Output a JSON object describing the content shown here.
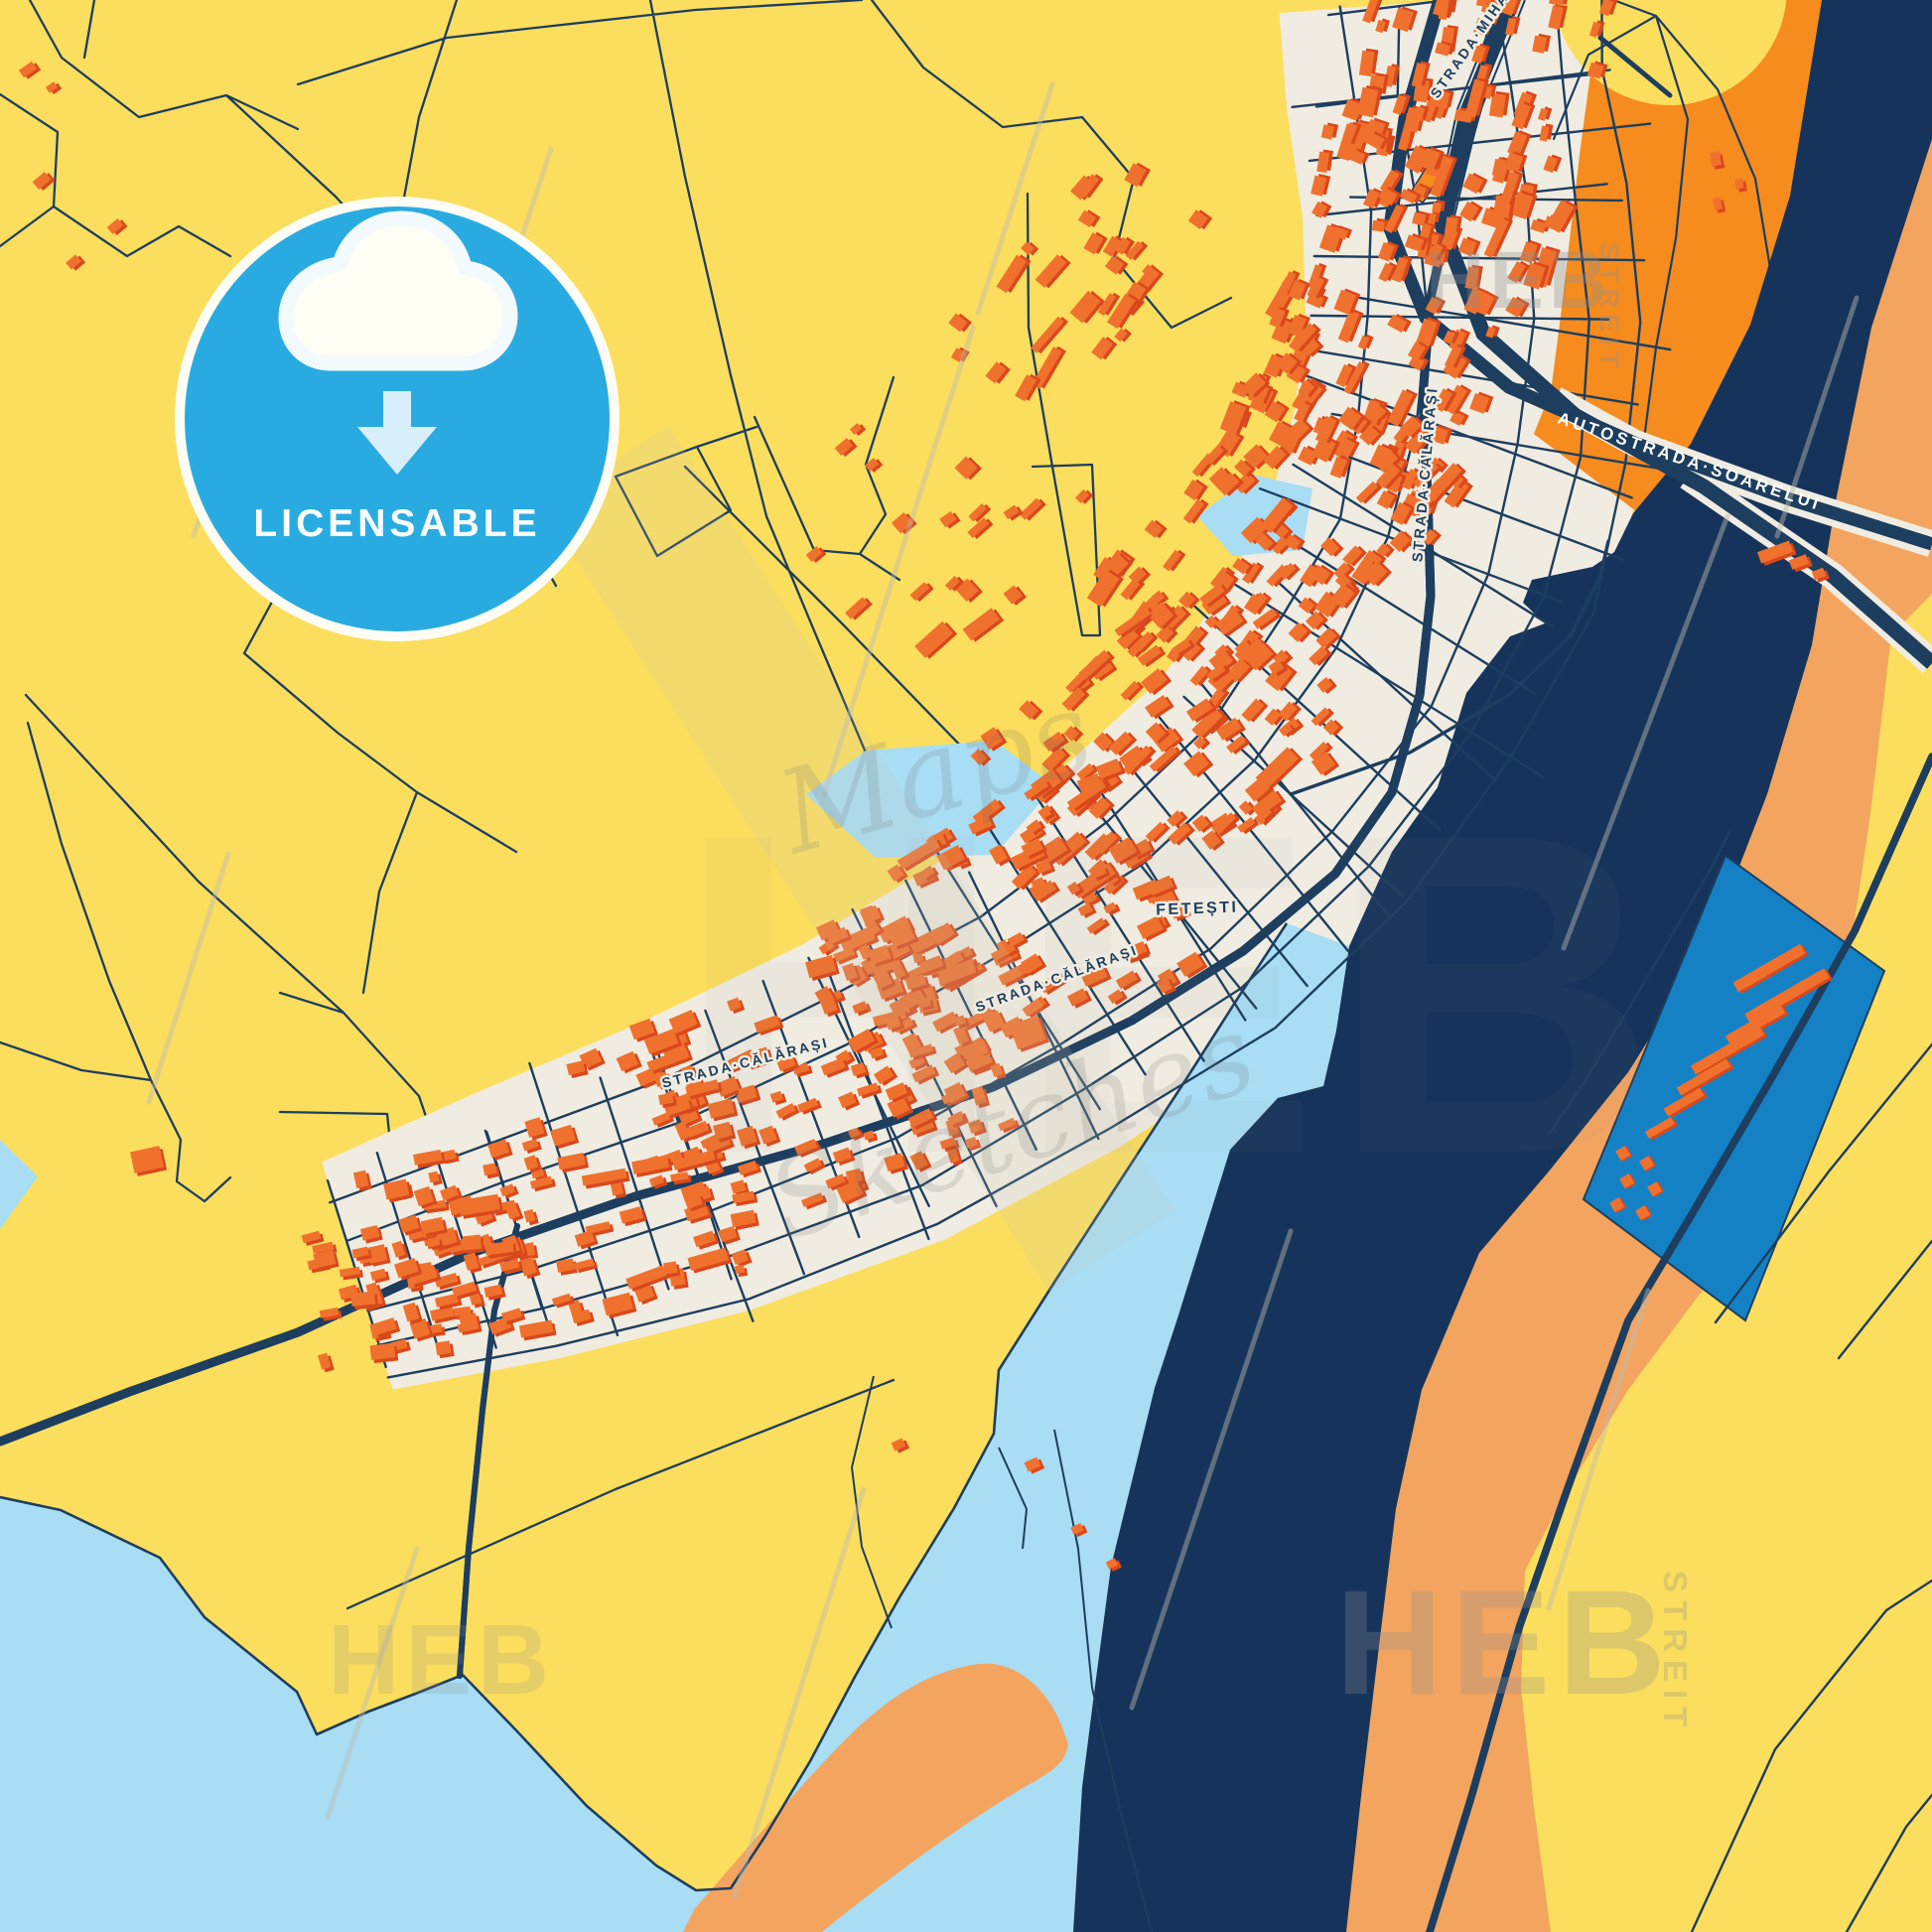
{
  "badge": {
    "label": "LICENSABLE"
  },
  "labels": {
    "city": "FETEȘTI",
    "strada_calarasi": "STRADA·CĂLĂRAȘI",
    "autostrada": "AUTOSTRADA·SOARELUI",
    "strada_mihail": "STRADA·MIHAIL·SADOVEANU"
  },
  "watermark": {
    "brand": "HEB",
    "brand_suffix": "STREIT",
    "script_top": "Maps",
    "script_bottom": "Sketches"
  },
  "colors": {
    "yellow": "#FBDE5D",
    "cream": "#F0ECE1",
    "line_navy": "#1D3E5F",
    "river_navy": "#16345B",
    "light_blue": "#A8DDF4",
    "harbor_blue": "#1581C5",
    "sand": "#F3A45F",
    "orange": "#F68B1E",
    "building": "#F0712D",
    "building_shadow": "#D9481C",
    "badge_blue": "#29ABE2",
    "badge_light": "#D7EFFB",
    "cloud_fill": "#FFFEF4",
    "cloud_stroke": "#F3FAFE",
    "scratch": "#BFBAB0"
  }
}
